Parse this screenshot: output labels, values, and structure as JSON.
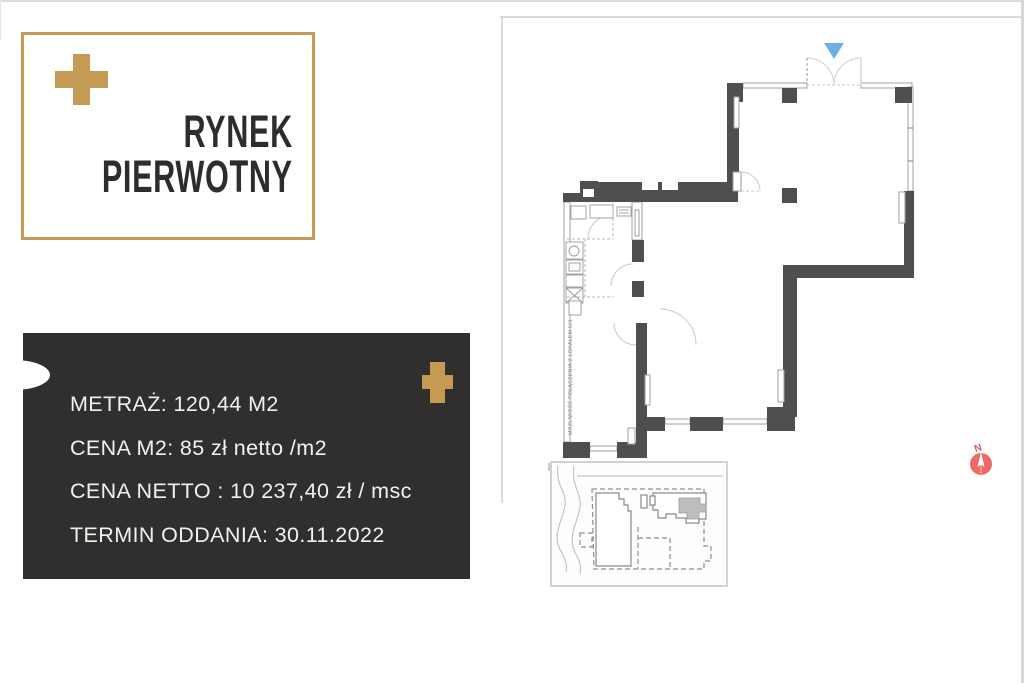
{
  "page": {
    "background": "#FFFFFF"
  },
  "logo_card": {
    "line1": "RYNEK",
    "line2": "PIERWOTNY",
    "border_color": "#C49B55",
    "text_color": "#2D2D2D",
    "plus_icon": "gold-plus"
  },
  "info_card": {
    "background": "#312F2D",
    "text_color": "#F2F1EF",
    "accent_color": "#C79A52",
    "plus_icon": "gold-plus",
    "lines": [
      "METRAŻ: 120,44 M2",
      "CENA M2: 85 zł netto /m2",
      "CENA NETTO : 10 237,40 zł / msc",
      "TERMIN ODDANIA: 30.11.2022"
    ]
  },
  "floor_plan": {
    "wall_color": "#4F4F4F",
    "window_color": "#A0A0A0",
    "entrance_marker_icon": "down-triangle",
    "entrance_marker_color": "#6DB0E8",
    "connection_label": "MOŻLIWOŚĆ POŁĄCZENIA Z LOKALEM U/1"
  },
  "site_plan": {
    "highlight_color": "#BDBDBD"
  },
  "compass": {
    "label": "N",
    "color": "#E8605C",
    "icon": "compass-north"
  }
}
